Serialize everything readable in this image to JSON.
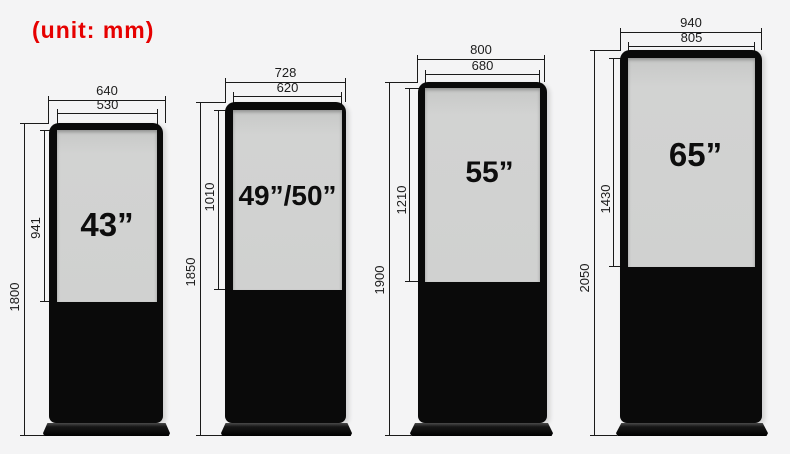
{
  "unit_label": "(unit: mm)",
  "colors": {
    "accent_red": "#e60000",
    "body_black": "#0a0a0a",
    "screen_gray": "#d1d2d1",
    "background": "#f4f4f5",
    "dimension_line": "#1a1a1a"
  },
  "kiosks": [
    {
      "name": "43-inch",
      "size_label": "43”",
      "outer_width": "640",
      "screen_width": "530",
      "screen_height": "941",
      "total_height": "1800"
    },
    {
      "name": "49-50-inch",
      "size_label": "49”/50”",
      "outer_width": "728",
      "screen_width": "620",
      "screen_height": "1010",
      "total_height": "1850"
    },
    {
      "name": "55-inch",
      "size_label": "55”",
      "outer_width": "800",
      "screen_width": "680",
      "screen_height": "1210",
      "total_height": "1900"
    },
    {
      "name": "65-inch",
      "size_label": "65”",
      "outer_width": "940",
      "screen_width": "805",
      "screen_height": "1430",
      "total_height": "2050"
    }
  ]
}
